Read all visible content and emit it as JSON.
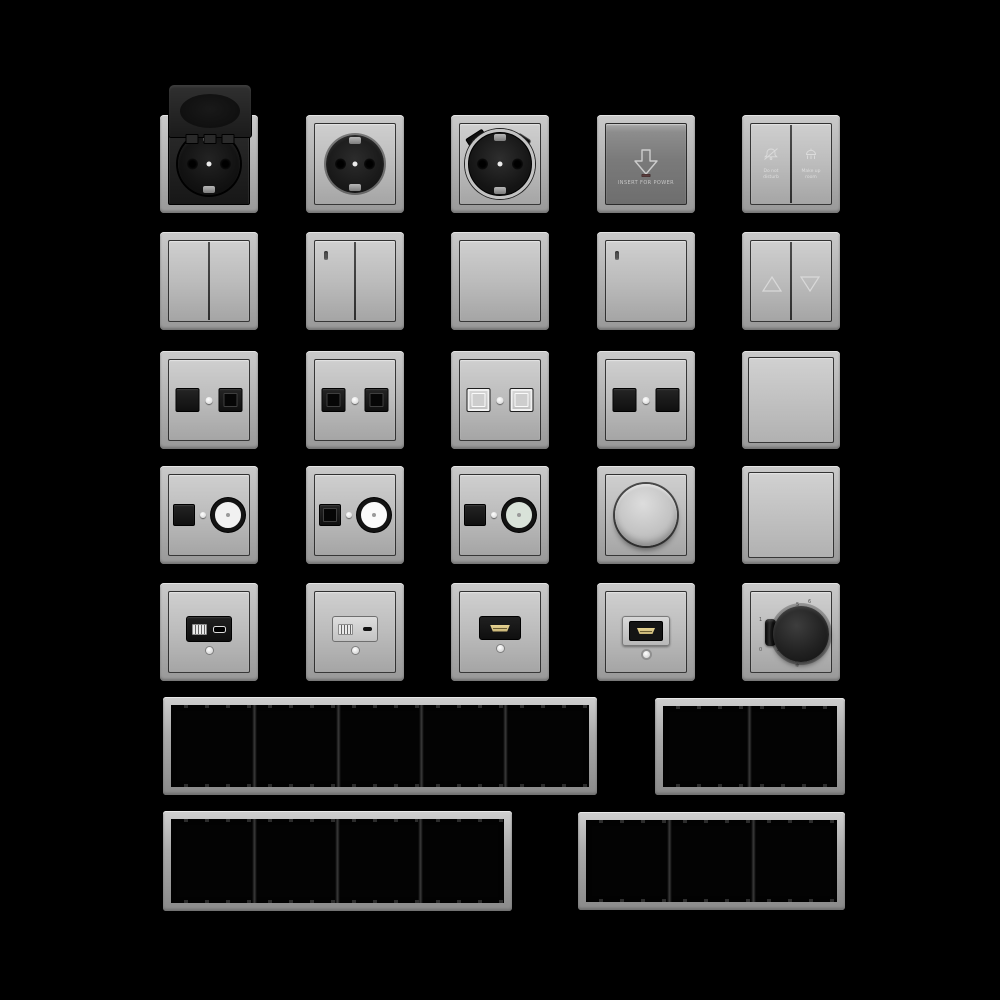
{
  "palette": {
    "background": "#000000",
    "frame_gray": "#b4b4b4",
    "face_gray": "#bcbcbc",
    "keycard_dark_gray": "#7a7a7a",
    "black_insert": "#161616",
    "hdmi_gold": "#d9c687",
    "led_red": "#5a3d3d",
    "indicator_white": "#f0f0f0"
  },
  "grid": {
    "rows": [
      {
        "name": "row-1-sockets",
        "items": [
          "schuko-socket-hinged-lid-black",
          "schuko-socket-gray",
          "schuko-socket-usb-a-c",
          "hotel-keycard-power-switch",
          "do-not-disturb-service-switch"
        ]
      },
      {
        "name": "row-2-rockers",
        "items": [
          "double-rocker-switch",
          "double-rocker-switch-indicator",
          "single-rocker-switch",
          "single-rocker-switch-indicator",
          "shutter-rocker-switch"
        ]
      },
      {
        "name": "row-3-data-sockets",
        "items": [
          "dual-data-socket",
          "dual-data-socket-keystone",
          "dual-data-socket-shuttered",
          "dual-data-socket-black",
          "blank-cover-plate"
        ]
      },
      {
        "name": "row-4-media",
        "items": [
          "data-coax-combo-socket",
          "data-coax-combo-socket-2",
          "data-coax-combo-socket-3",
          "rotary-dimmer",
          "blank-cover-plate-2"
        ]
      },
      {
        "name": "row-5-modules",
        "items": [
          "usb-charger-black",
          "usb-charger-light",
          "hdmi-socket-black",
          "hdmi-socket-gray",
          "thermostat-dial"
        ]
      },
      {
        "name": "row-6-frames",
        "items": [
          "frame-5-gang",
          "frame-2-gang"
        ]
      },
      {
        "name": "row-7-frames",
        "items": [
          "frame-4-gang",
          "frame-3-gang"
        ]
      }
    ]
  },
  "keycard": {
    "icon": "arrow-down-icon",
    "label": "INSERT FOR POWER"
  },
  "dnd": {
    "left": {
      "icon": "bell-slash-icon",
      "line1": "Do not",
      "line2": "disturb"
    },
    "right": {
      "icon": "cleaning-brush-icon",
      "line1": "Make up",
      "line2": "room"
    }
  },
  "shutter": {
    "up_icon": "triangle-up-icon",
    "down_icon": "triangle-down-icon"
  },
  "thermostat": {
    "scale": {
      "n2": "2",
      "n3": "3",
      "n4": "4",
      "n5": "5",
      "n6": "6"
    },
    "frost": "❄",
    "switch": {
      "on": "1",
      "off": "0"
    }
  }
}
